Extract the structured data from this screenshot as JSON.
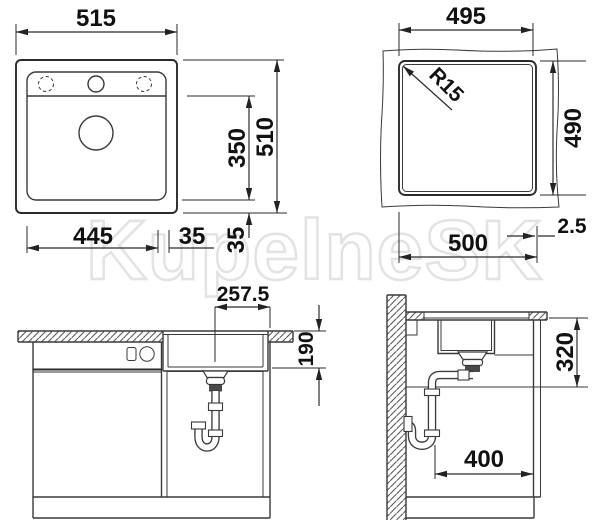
{
  "watermark": {
    "text": "KupelneSK"
  },
  "drawing": {
    "line_color": "#3a3a3a",
    "views": {
      "top_view": {
        "overall_width": "515",
        "overall_height": "510",
        "bowl_inner_height": "350",
        "bowl_inner_width": "445",
        "right_offset": "35",
        "bottom_offset": "35"
      },
      "cutout_view": {
        "inner_width": "495",
        "inner_height": "490",
        "cutout_width": "500",
        "corner_radius": "R15",
        "edge_gap": "2.5"
      },
      "front_view": {
        "drain_center_offset": "257.5",
        "bowl_depth": "190"
      },
      "side_view": {
        "under_counter_height": "320",
        "trap_clearance": "400"
      }
    }
  }
}
